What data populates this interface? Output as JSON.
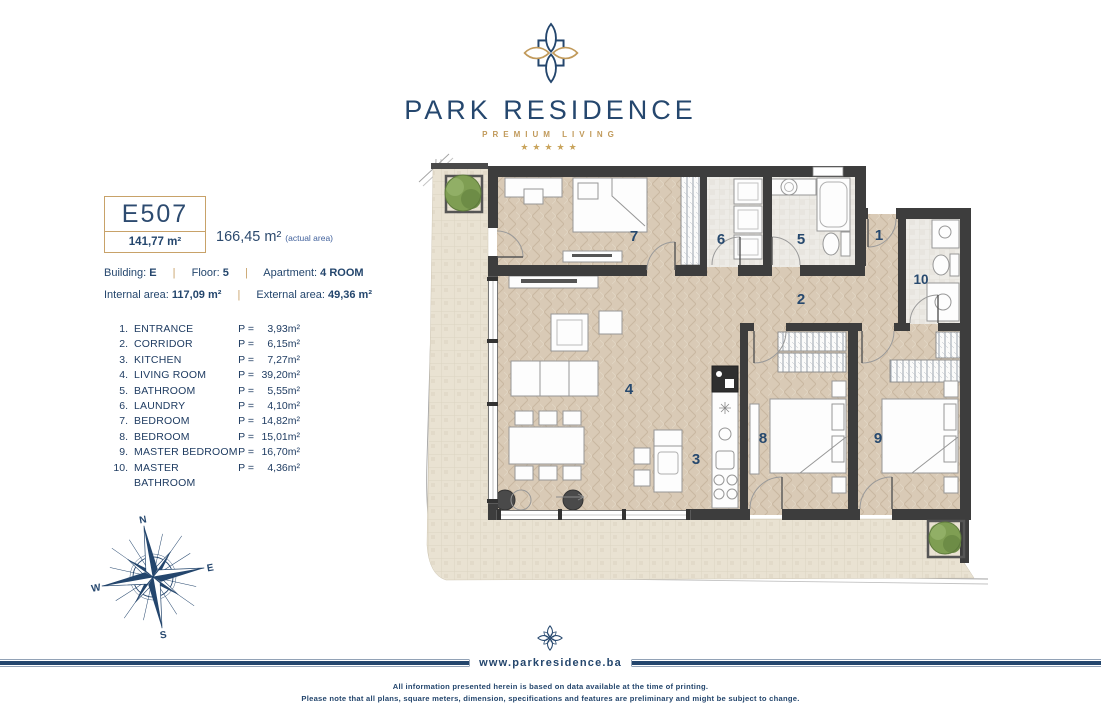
{
  "brand": {
    "name": "PARK RESIDENCE",
    "tagline": "PREMIUM LIVING",
    "stars": "★★★★★"
  },
  "unit": {
    "code": "E507",
    "net_area": "141,77 m²",
    "actual_area": "166,45 m²",
    "actual_note": "(actual area)"
  },
  "details": {
    "building_label": "Building:",
    "building_value": "E",
    "floor_label": "Floor:",
    "floor_value": "5",
    "apartment_label": "Apartment:",
    "apartment_value": "4 ROOM",
    "internal_label": "Internal area:",
    "internal_value": "117,09 m²",
    "external_label": "External area:",
    "external_value": "49,36 m²",
    "separator": "|"
  },
  "area_prefix": "P =",
  "rooms": [
    {
      "id": "1",
      "num": "1.",
      "name": "ENTRANCE",
      "area": "3,93m²"
    },
    {
      "id": "2",
      "num": "2.",
      "name": "CORRIDOR",
      "area": "6,15m²"
    },
    {
      "id": "3",
      "num": "3.",
      "name": "KITCHEN",
      "area": "7,27m²"
    },
    {
      "id": "4",
      "num": "4.",
      "name": "LIVING ROOM",
      "area": "39,20m²"
    },
    {
      "id": "5",
      "num": "5.",
      "name": "BATHROOM",
      "area": "5,55m²"
    },
    {
      "id": "6",
      "num": "6.",
      "name": "LAUNDRY",
      "area": "4,10m²"
    },
    {
      "id": "7",
      "num": "7.",
      "name": "BEDROOM",
      "area": "14,82m²"
    },
    {
      "id": "8",
      "num": "8.",
      "name": "BEDROOM",
      "area": "15,01m²"
    },
    {
      "id": "9",
      "num": "9.",
      "name": "MASTER BEDROOM",
      "area": "16,70m²"
    },
    {
      "id": "10",
      "num": "10.",
      "name": "MASTER BATHROOM",
      "area": "4,36m²"
    }
  ],
  "compass": {
    "n": "N",
    "e": "E",
    "s": "S",
    "w": "W"
  },
  "footer": {
    "website": "www.parkresidence.ba",
    "line1": "All information presented herein is based on data available at the time of printing.",
    "line2": "Please note that all plans, square meters, dimension, specifications and features are preliminary and might be subject to change."
  },
  "colors": {
    "navy": "#24466d",
    "gold": "#c19a5b",
    "wall": "#3d3d3d",
    "floor_wood": "#d9cab6",
    "floor_tile": "#e9e2d2",
    "floor_bath": "#edebe6"
  }
}
